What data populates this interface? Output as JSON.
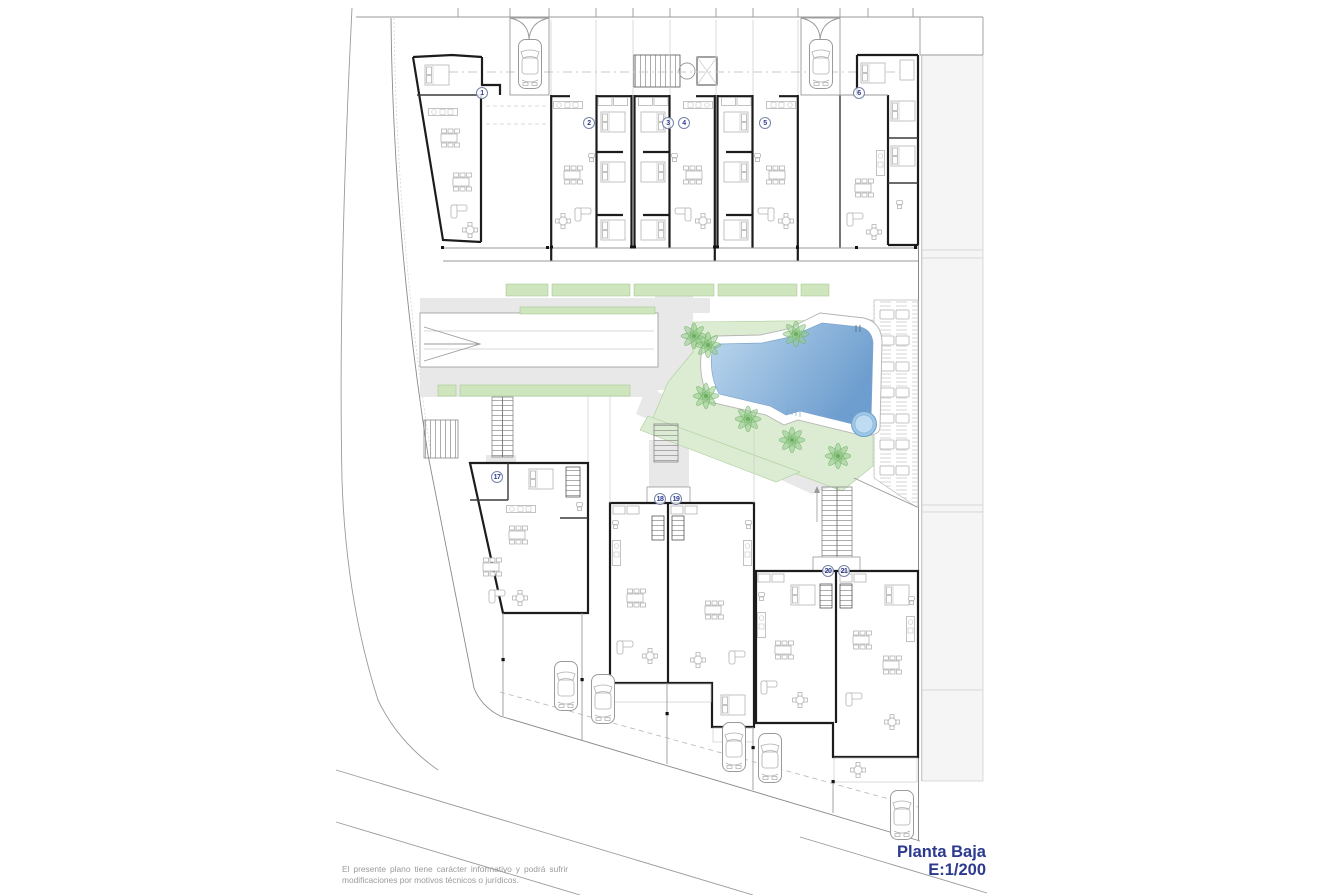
{
  "colors": {
    "accent": "#2b3990",
    "pool-light": "#bdd8ee",
    "pool-dark": "#6e9ecf",
    "garden": "#dcecd2",
    "hedge": "#cfe5bd",
    "palm": "#94cb8b",
    "path": "#e8e8e8",
    "wall": "#1c1c1c"
  },
  "title_block": {
    "name": "Planta Baja",
    "scale": "E:1/200"
  },
  "disclaimer": "El presente plano tiene carácter informativo y podrá sufrir modificaciones por motivos técnicos o jurídicos.",
  "plan": {
    "unit_numbers": [
      "1",
      "2",
      "3",
      "4",
      "5",
      "6",
      "17",
      "18",
      "19",
      "20",
      "21"
    ]
  }
}
